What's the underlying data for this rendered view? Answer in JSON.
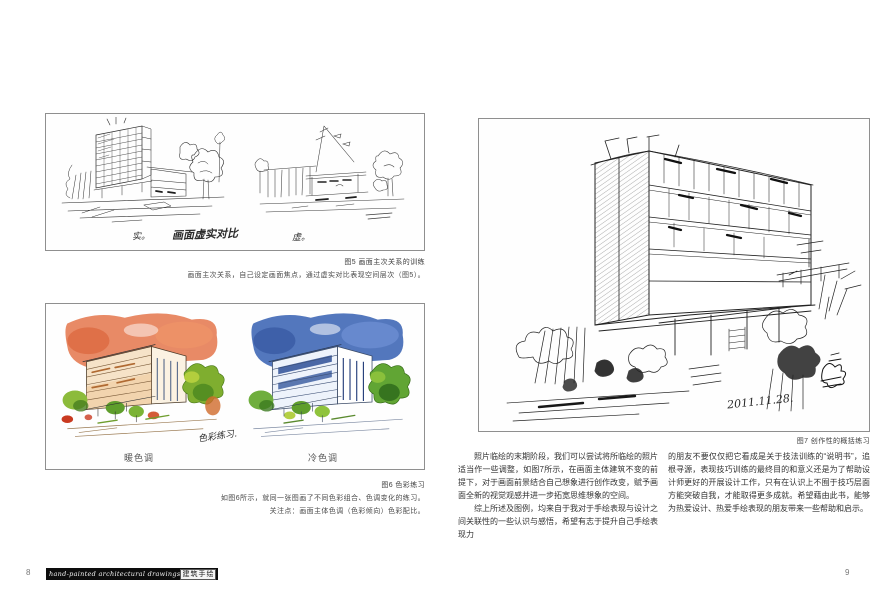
{
  "page_left": {
    "page_number": "8",
    "figure5": {
      "annotation_left": "实。",
      "annotation_center": "画面虚实对比",
      "annotation_right": "虚。",
      "caption_title": "图5 画面主次关系的训练",
      "caption_text": "画面主次关系，自己设定画面焦点，通过虚实对比表现空间层次（图5）。"
    },
    "figure6": {
      "handwriting": "色彩练习.",
      "label_warm": "暖色调",
      "label_cool": "冷色调",
      "caption_title": "图6 色彩练习",
      "caption_line1": "如图6所示，就同一张图画了不同色彩组合、色调变化的练习。",
      "caption_line2": "关注点：画面主体色调（色彩倾向）色彩配比。"
    },
    "footer": {
      "series_title_en": "hand-painted architectural drawings",
      "series_title_cn": "建筑手绘"
    }
  },
  "page_right": {
    "page_number": "9",
    "figure7": {
      "date_inscription": "2011.11.28.",
      "caption_title": "图7 创作性的概括练习"
    },
    "body": {
      "col1_p1": "照片临绘的末期阶段，我们可以尝试将所临绘的照片适当作一些调整，如图7所示，在画面主体建筑不变的前提下，对于画面前景结合自己想象进行创作改变，赋予画面全新的视觉观感并进一步拓宽思维想象的空间。",
      "col1_p2": "综上所述及图例，均来自于我对于手绘表现与设计之间关联性的一些认识与感悟，希望有志于提升自己手绘表现力",
      "col2_p1": "的朋友不要仅仅把它看成是关于技法训练的“说明书”，追根寻源，表现技巧训练的最终目的和意义还是为了帮助设计师更好的开展设计工作，只有在认识上不囿于技巧层面方能突破自我，才能取得更多成就。希望藉由此书，能够为热爱设计、热爱手绘表现的朋友带来一些帮助和启示。"
    }
  },
  "colors": {
    "warm_sky": "#e4764b",
    "cool_sky": "#4068b6",
    "foliage_green": "#7fae2f",
    "accent_red": "#c93a20",
    "ink": "#2a2a2a"
  }
}
